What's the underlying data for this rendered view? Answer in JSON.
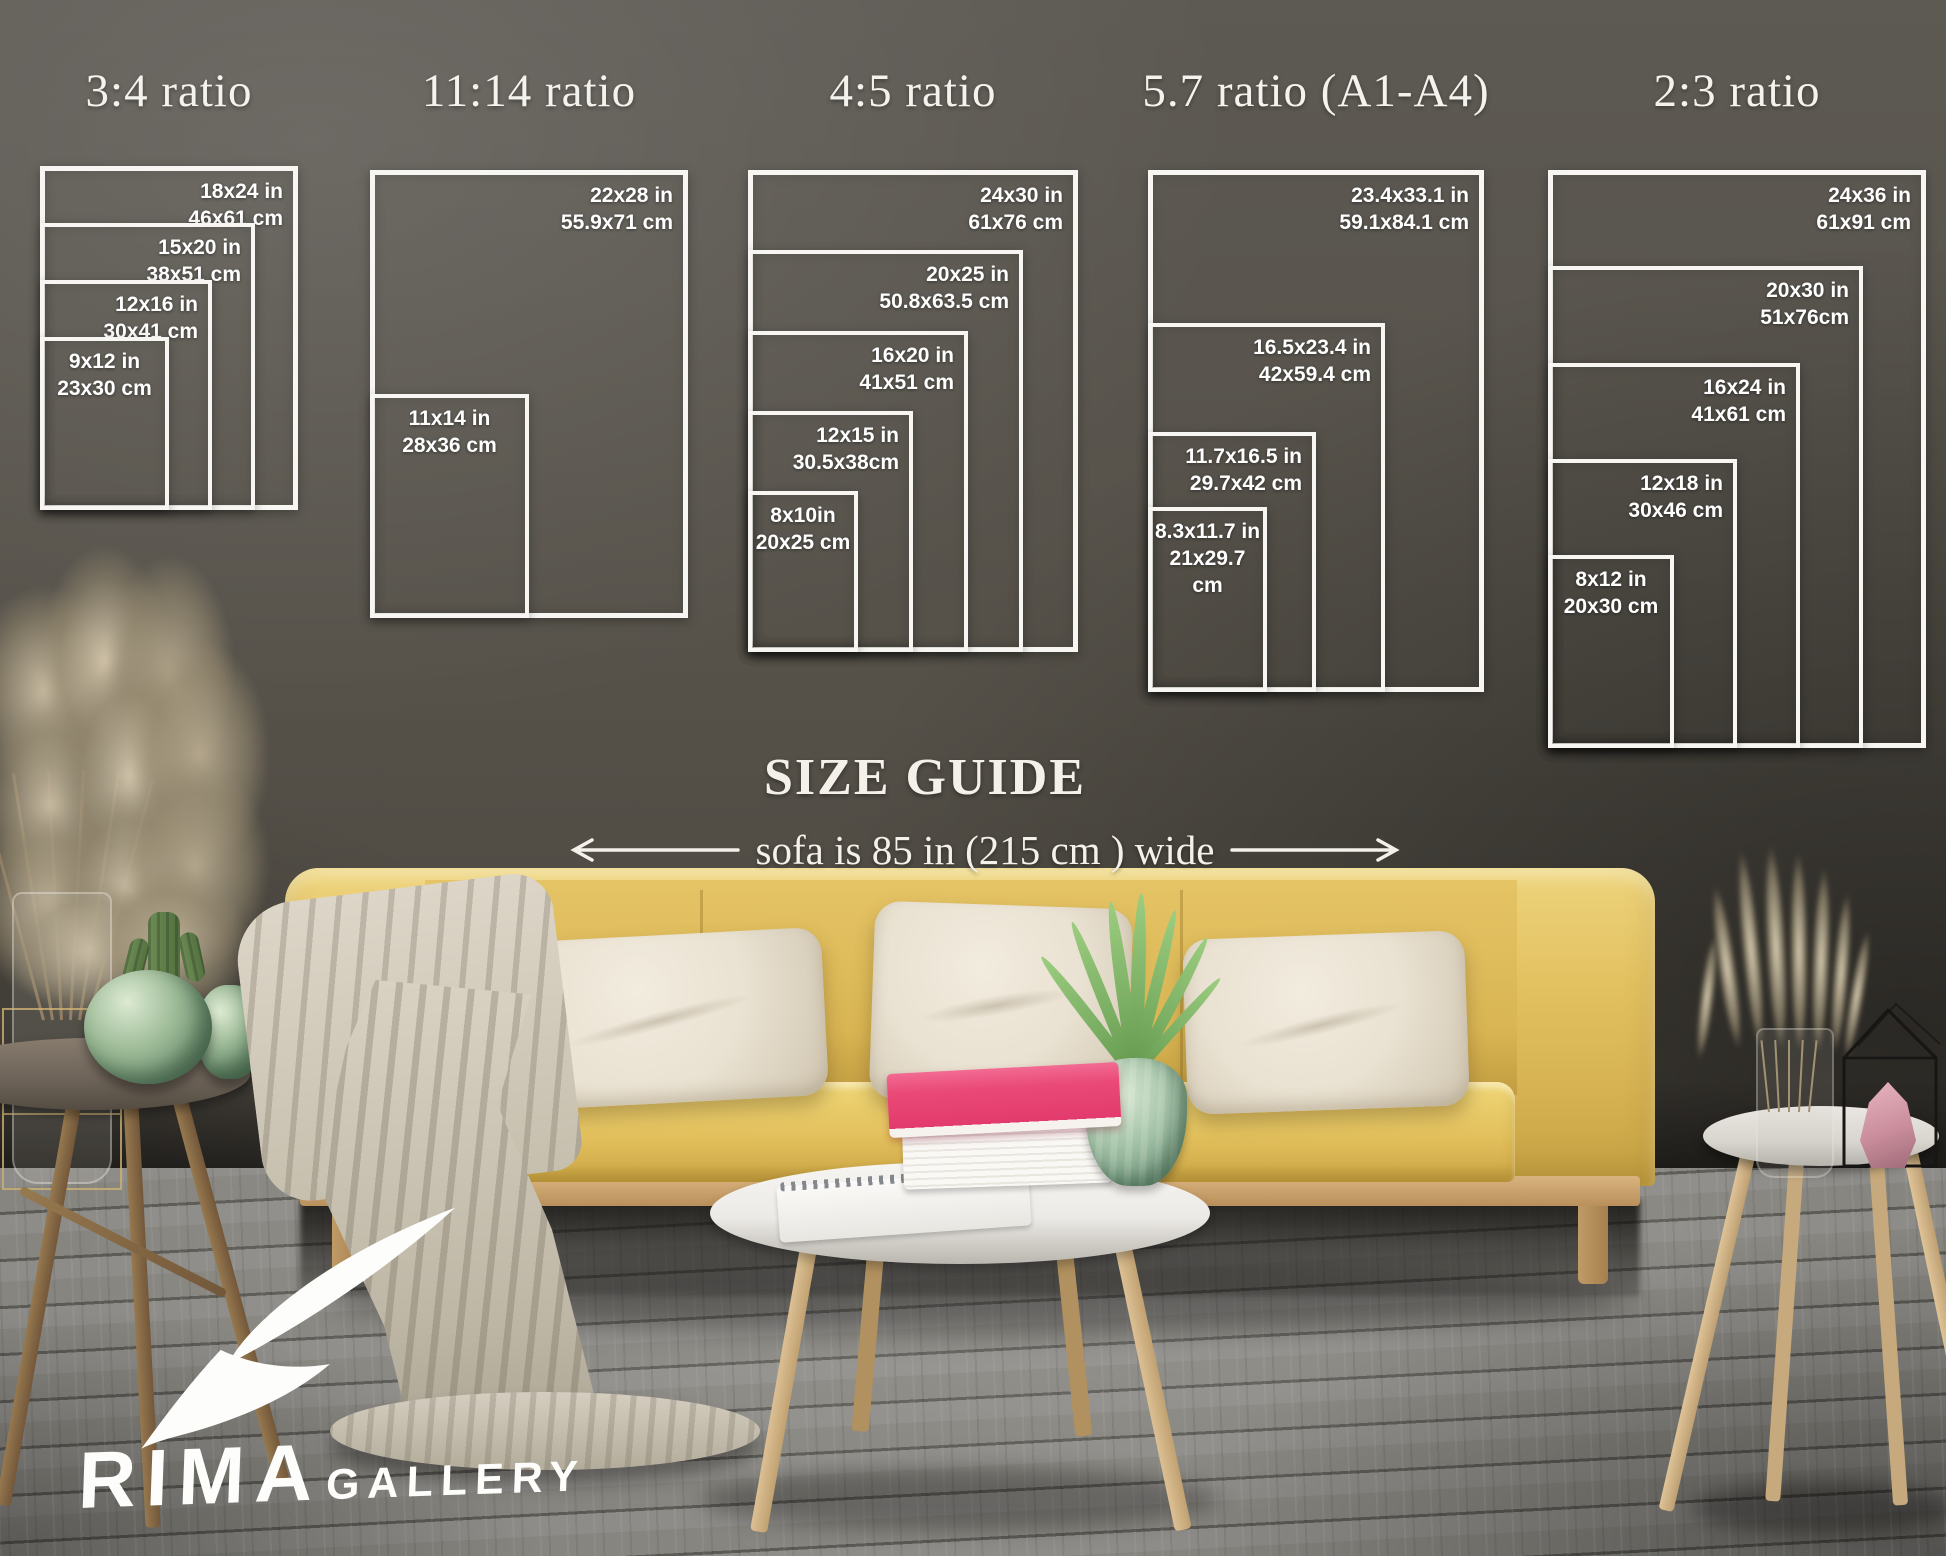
{
  "size_guide": {
    "heading": "SIZE GUIDE",
    "sofa_note": "sofa is 85 in (215 cm ) wide",
    "groups": [
      {
        "title": "3:4 ratio",
        "sizes": [
          {
            "in": "18x24 in",
            "cm": "46x61 cm"
          },
          {
            "in": "15x20 in",
            "cm": "38x51 cm"
          },
          {
            "in": "12x16 in",
            "cm": "30x41 cm"
          },
          {
            "in": "9x12 in",
            "cm": "23x30 cm"
          }
        ]
      },
      {
        "title": "11:14 ratio",
        "sizes": [
          {
            "in": "22x28 in",
            "cm": "55.9x71 cm"
          },
          {
            "in": "11x14 in",
            "cm": "28x36 cm"
          }
        ]
      },
      {
        "title": "4:5 ratio",
        "sizes": [
          {
            "in": "24x30 in",
            "cm": "61x76 cm"
          },
          {
            "in": "20x25 in",
            "cm": "50.8x63.5 cm"
          },
          {
            "in": "16x20 in",
            "cm": "41x51 cm"
          },
          {
            "in": "12x15 in",
            "cm": "30.5x38cm"
          },
          {
            "in": "8x10in",
            "cm": "20x25 cm"
          }
        ]
      },
      {
        "title": "5.7 ratio (A1-A4)",
        "sizes": [
          {
            "in": "23.4x33.1 in",
            "cm": "59.1x84.1 cm"
          },
          {
            "in": "16.5x23.4 in",
            "cm": "42x59.4 cm"
          },
          {
            "in": "11.7x16.5 in",
            "cm": "29.7x42 cm"
          },
          {
            "in": "8.3x11.7 in",
            "cm": "21x29.7 cm"
          }
        ]
      },
      {
        "title": "2:3 ratio",
        "sizes": [
          {
            "in": "24x36 in",
            "cm": "61x91 cm"
          },
          {
            "in": "20x30 in",
            "cm": "51x76cm"
          },
          {
            "in": "16x24 in",
            "cm": "41x61 cm"
          },
          {
            "in": "12x18 in",
            "cm": "30x46 cm"
          },
          {
            "in": "8x12 in",
            "cm": "20x30 cm"
          }
        ]
      }
    ]
  },
  "logo": {
    "brand": "RIMA",
    "suffix": "GALLERY"
  },
  "colors": {
    "overlay_white": "#ffffff",
    "wall_gray": "#57544e",
    "floor_gray": "#8b8987",
    "sofa_yellow": "#e2c05e",
    "pillow_cream": "#ebe4d6",
    "book_pink": "#e8487c",
    "plant_green": "#7db364",
    "vase_green": "#9cb9a0"
  }
}
